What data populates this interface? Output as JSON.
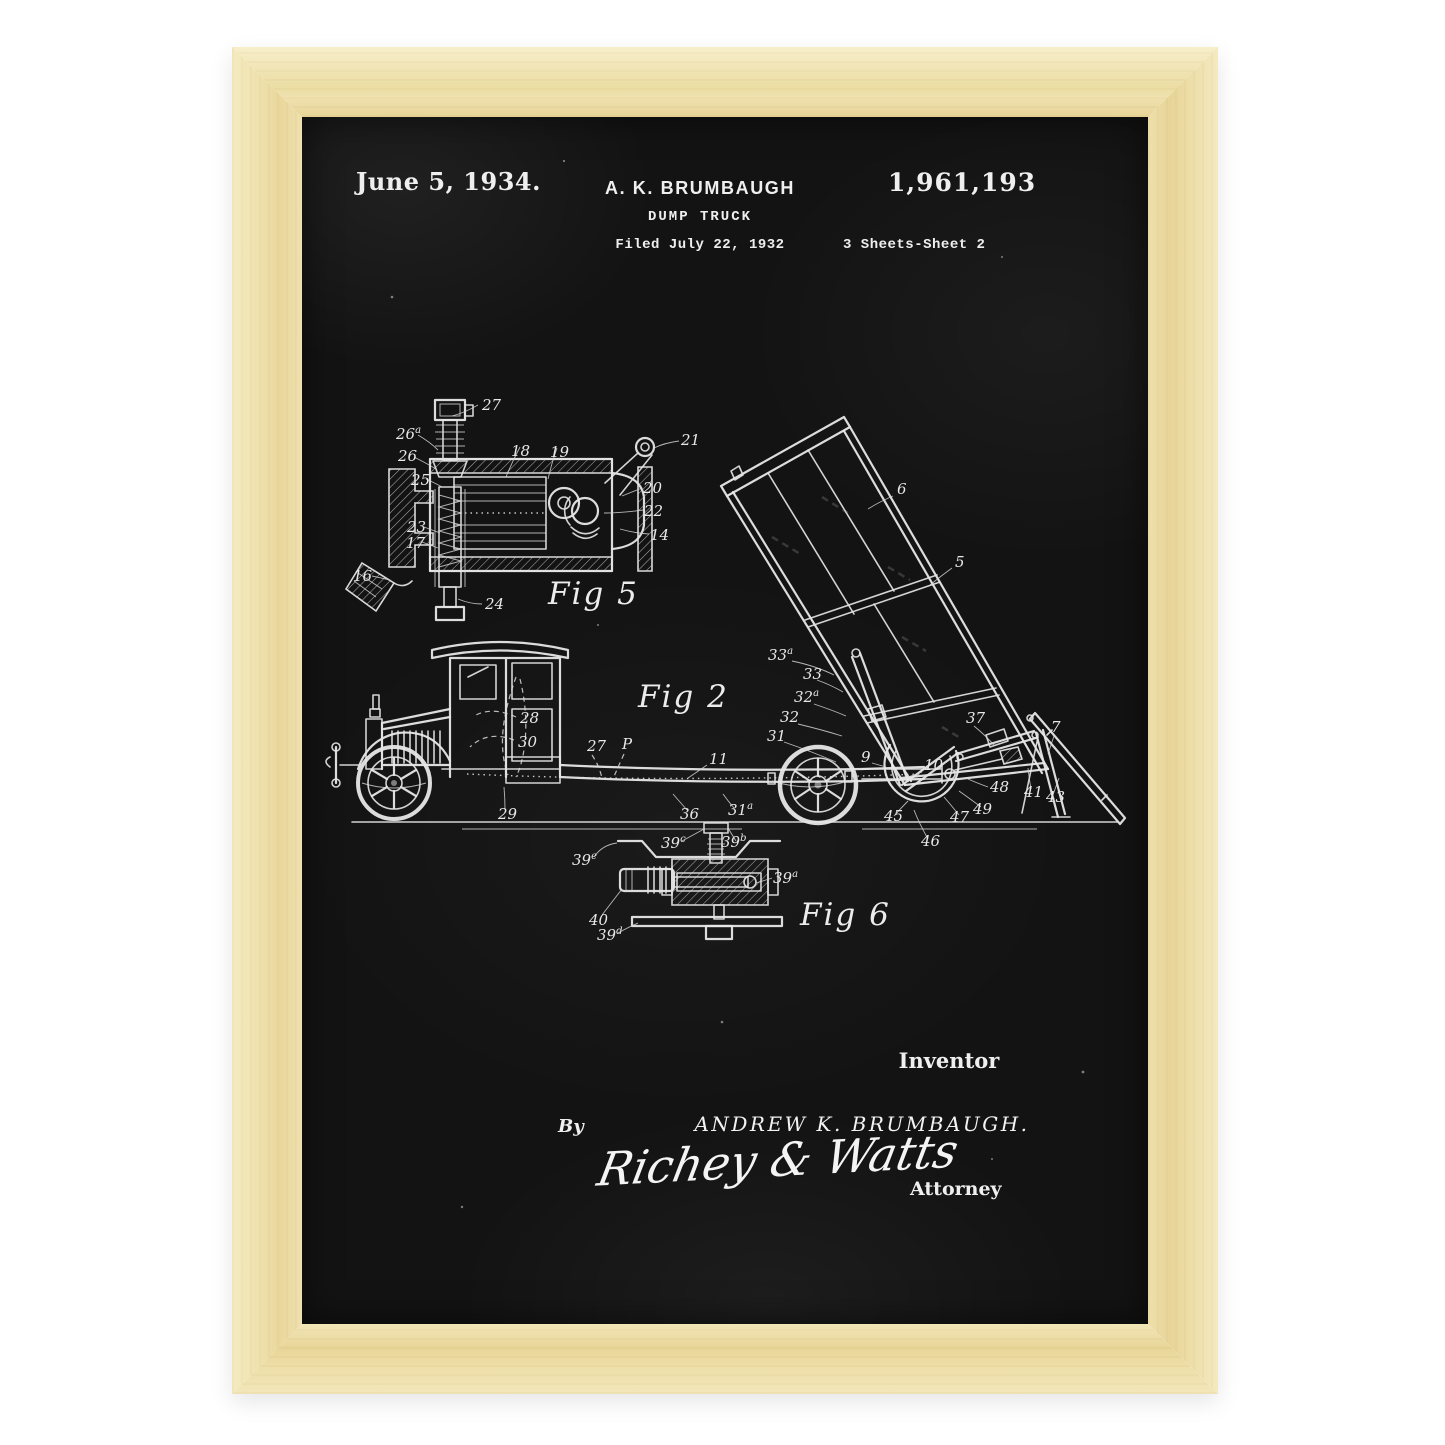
{
  "colors": {
    "frame_wood": "#eedfa9",
    "poster_background": "#131313",
    "chalk_line": "#e6e6e6"
  },
  "poster": {
    "header": {
      "date": "June 5, 1934.",
      "inventor": "A. K. BRUMBAUGH",
      "patent_number": "1,961,193",
      "title": "DUMP TRUCK",
      "filed": "Filed July 22, 1932",
      "sheet": "3 Sheets-Sheet  2"
    },
    "footer": {
      "inventor_label": "Inventor",
      "by_label": "By",
      "inventor_name": "ANDREW K. BRUMBAUGH.",
      "attorney_signature": "Richey & Watts",
      "attorney_label": "Attorney"
    },
    "figures": [
      {
        "id": "fig5",
        "label": "Fig 5",
        "label_x": 246,
        "label_y": 487,
        "numerals": [
          {
            "t": "27",
            "x": 180,
            "y": 293
          },
          {
            "t": "26",
            "sup": "a",
            "x": 94,
            "y": 322
          },
          {
            "t": "26",
            "x": 96,
            "y": 344
          },
          {
            "t": "25",
            "x": 109,
            "y": 368
          },
          {
            "t": "23",
            "x": 105,
            "y": 415
          },
          {
            "t": "17",
            "x": 104,
            "y": 431
          },
          {
            "t": "16",
            "x": 51,
            "y": 464
          },
          {
            "t": "24",
            "x": 183,
            "y": 492
          },
          {
            "t": "18",
            "x": 209,
            "y": 339
          },
          {
            "t": "19",
            "x": 248,
            "y": 340
          },
          {
            "t": "21",
            "x": 379,
            "y": 328
          },
          {
            "t": "20",
            "x": 341,
            "y": 376
          },
          {
            "t": "22",
            "x": 342,
            "y": 399
          },
          {
            "t": "14",
            "x": 348,
            "y": 423
          }
        ]
      },
      {
        "id": "fig2",
        "label": "Fig 2",
        "label_x": 336,
        "label_y": 590,
        "numerals": [
          {
            "t": "28",
            "x": 218,
            "y": 606
          },
          {
            "t": "30",
            "x": 216,
            "y": 630
          },
          {
            "t": "27",
            "x": 285,
            "y": 634
          },
          {
            "t": "P",
            "x": 320,
            "y": 632
          },
          {
            "t": "11",
            "x": 407,
            "y": 647
          },
          {
            "t": "29",
            "x": 196,
            "y": 702
          },
          {
            "t": "36",
            "x": 378,
            "y": 702
          },
          {
            "t": "31",
            "sup": "a",
            "x": 426,
            "y": 698
          },
          {
            "t": "33",
            "sup": "a",
            "x": 466,
            "y": 543
          },
          {
            "t": "33",
            "x": 501,
            "y": 562
          },
          {
            "t": "32",
            "sup": "a",
            "x": 492,
            "y": 585
          },
          {
            "t": "32",
            "x": 478,
            "y": 605
          },
          {
            "t": "31",
            "x": 465,
            "y": 624
          },
          {
            "t": "6",
            "x": 595,
            "y": 377
          },
          {
            "t": "5",
            "x": 653,
            "y": 450
          },
          {
            "t": "9",
            "x": 559,
            "y": 645
          },
          {
            "t": "10",
            "x": 622,
            "y": 653
          },
          {
            "t": "37",
            "x": 664,
            "y": 606
          },
          {
            "t": "7",
            "x": 749,
            "y": 615
          },
          {
            "t": "48",
            "x": 688,
            "y": 675
          },
          {
            "t": "41",
            "x": 722,
            "y": 680
          },
          {
            "t": "43",
            "x": 744,
            "y": 685
          },
          {
            "t": "45",
            "x": 582,
            "y": 704
          },
          {
            "t": "46",
            "x": 619,
            "y": 729
          },
          {
            "t": "47",
            "x": 648,
            "y": 705
          },
          {
            "t": "49",
            "x": 671,
            "y": 697
          }
        ]
      },
      {
        "id": "fig6",
        "label": "Fig 6",
        "label_x": 498,
        "label_y": 808,
        "numerals": [
          {
            "t": "39",
            "sup": "e",
            "x": 270,
            "y": 748
          },
          {
            "t": "39",
            "sup": "c",
            "x": 359,
            "y": 731
          },
          {
            "t": "39",
            "sup": "b",
            "x": 419,
            "y": 730
          },
          {
            "t": "39",
            "sup": "a",
            "x": 471,
            "y": 766
          },
          {
            "t": "40",
            "x": 287,
            "y": 808
          },
          {
            "t": "39",
            "sup": "d",
            "x": 295,
            "y": 823
          }
        ]
      }
    ]
  }
}
